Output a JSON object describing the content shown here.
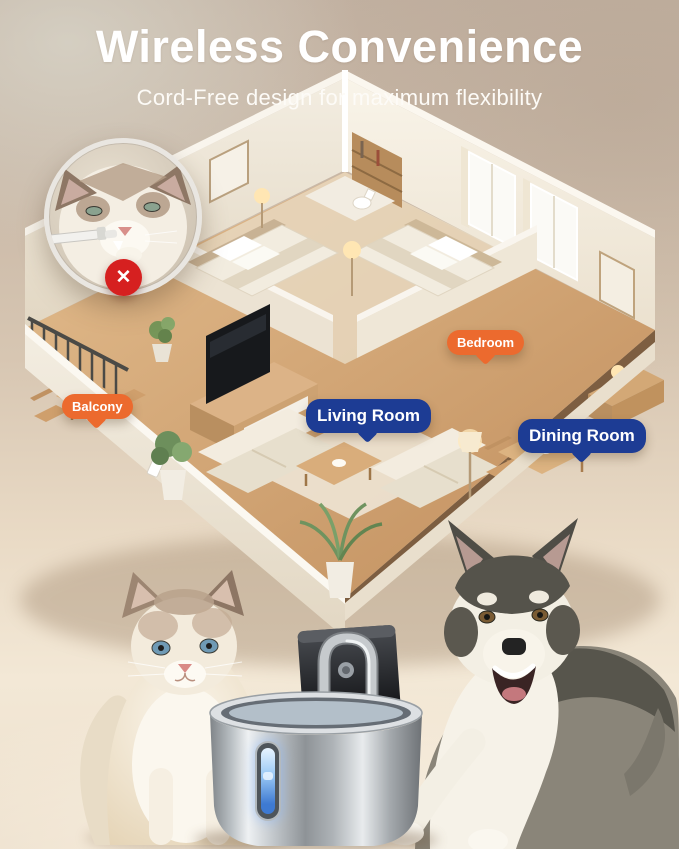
{
  "header": {
    "title": "Wireless Convenience",
    "subtitle": "Cord-Free design for maximum flexibility"
  },
  "floorplan": {
    "labels": [
      {
        "id": "balcony",
        "text": "Balcony",
        "color": "#ec6a2e"
      },
      {
        "id": "bedroom",
        "text": "Bedroom",
        "color": "#ec6a2e"
      },
      {
        "id": "living-room",
        "text": "Living Room",
        "color": "#1d3c94"
      },
      {
        "id": "dining-room",
        "text": "Dining Room",
        "color": "#1d3c94"
      }
    ]
  },
  "inset": {
    "badge_glyph": "✕",
    "badge_color": "#d62020"
  },
  "colors": {
    "accent_orange": "#ec6a2e",
    "accent_blue": "#1d3c94",
    "badge_red": "#d62020",
    "background_top": "#c2b1a1",
    "background_bottom": "#f3e8d6",
    "steel": "#c2c7cb",
    "water_glow": "#3e7ad2"
  }
}
